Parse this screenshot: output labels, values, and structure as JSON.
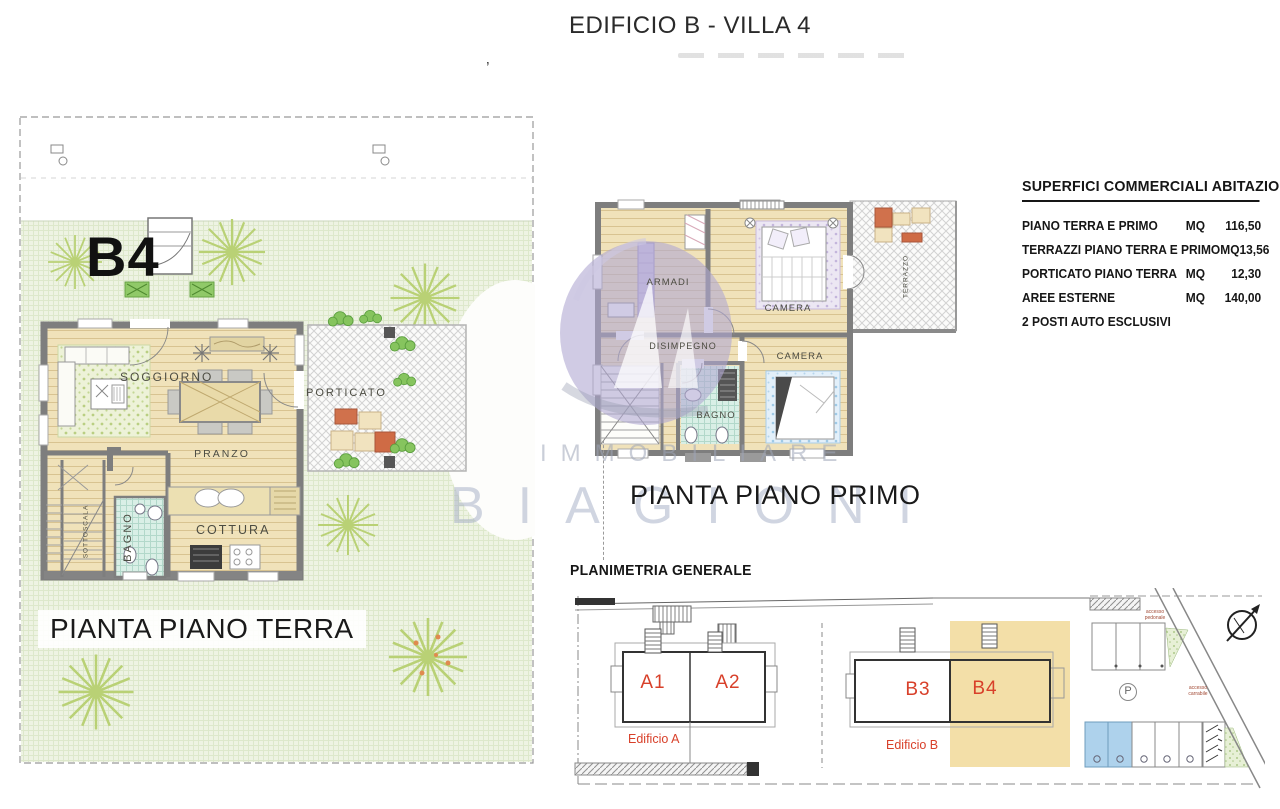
{
  "page": {
    "title": "EDIFICIO B - VILLA 4",
    "stray_mark": "’"
  },
  "ground_floor": {
    "unit": "B4",
    "caption": "PIANTA PIANO TERRA",
    "rooms": {
      "soggiorno": "SOGGIORNO",
      "pranzo": "PRANZO",
      "cottura": "COTTURA",
      "bagno": "BAGNO",
      "sottoscala": "SOTTOSCALA",
      "porticato": "PORTICATO"
    }
  },
  "first_floor": {
    "caption": "PIANTA PIANO PRIMO",
    "rooms": {
      "armadi": "ARMADI",
      "camera1": "CAMERA",
      "disimpegno": "DISIMPEGNO",
      "bagno": "BAGNO",
      "camera2": "CAMERA",
      "terrazzo": "TERRAZZO"
    }
  },
  "surfaces": {
    "title": "SUPERFICI COMMERCIALI ABITAZIONE",
    "rows": [
      {
        "label": "PIANO TERRA E PRIMO",
        "unit": "MQ",
        "value": "116,50"
      },
      {
        "label": "TERRAZZI PIANO TERRA E PRIMO",
        "unit": "MQ",
        "value": "13,56"
      },
      {
        "label": "PORTICATO PIANO TERRA",
        "unit": "MQ",
        "value": "12,30"
      },
      {
        "label": "AREE ESTERNE",
        "unit": "MQ",
        "value": "140,00"
      },
      {
        "label": "2 POSTI AUTO ESCLUSIVI",
        "unit": "",
        "value": ""
      }
    ]
  },
  "site_plan": {
    "title": "PLANIMETRIA GENERALE",
    "units": {
      "a1": "A1",
      "a2": "A2",
      "b3": "B3",
      "b4": "B4"
    },
    "buildings": {
      "a": "Edificio A",
      "b": "Edificio B"
    },
    "parking": "P",
    "access_pedestrian": "accesso pedonale",
    "access_vehicle": "accesso carrabile"
  },
  "watermark": {
    "line1": "IMMOBILIARE",
    "line2": "BIAGIONI"
  },
  "colors": {
    "accent_red": "#d8402a",
    "highlight_tan": "#f3dfa8",
    "parking_blue": "#aed2ec",
    "watermark_lavender": "#b0a8d2",
    "grass_green": "#eef3e3"
  }
}
